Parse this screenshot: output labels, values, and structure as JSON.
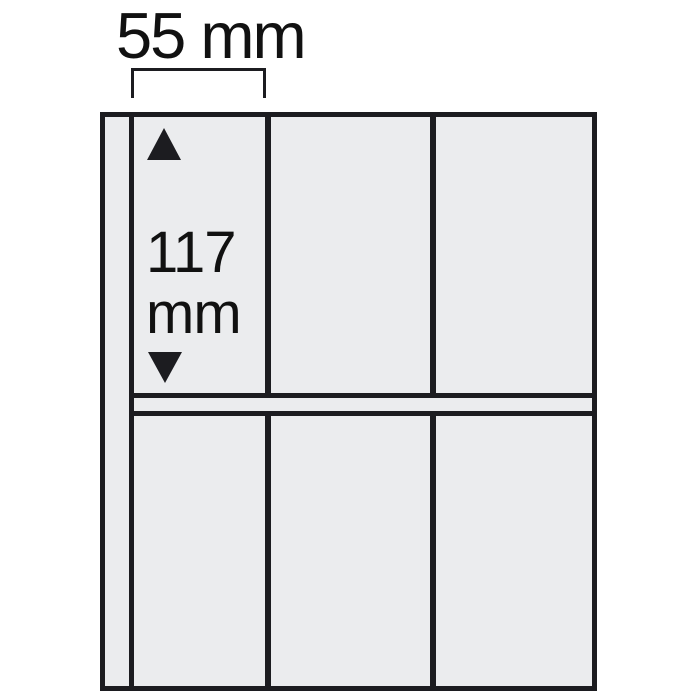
{
  "diagram": {
    "title": "album-pocket-page-dimension-diagram",
    "width_label": "55 mm",
    "height_label": {
      "line1": "117",
      "line2": "mm"
    },
    "grid": {
      "rows": 2,
      "columns": 3,
      "pocket_count": 6
    },
    "dimensions_shown": {
      "pocket_width_mm": 55,
      "pocket_height_mm": 117
    }
  },
  "colors": {
    "background": "#ffffff",
    "page_fill": "#ebecee",
    "line": "#1c1c20",
    "text": "#111111"
  }
}
